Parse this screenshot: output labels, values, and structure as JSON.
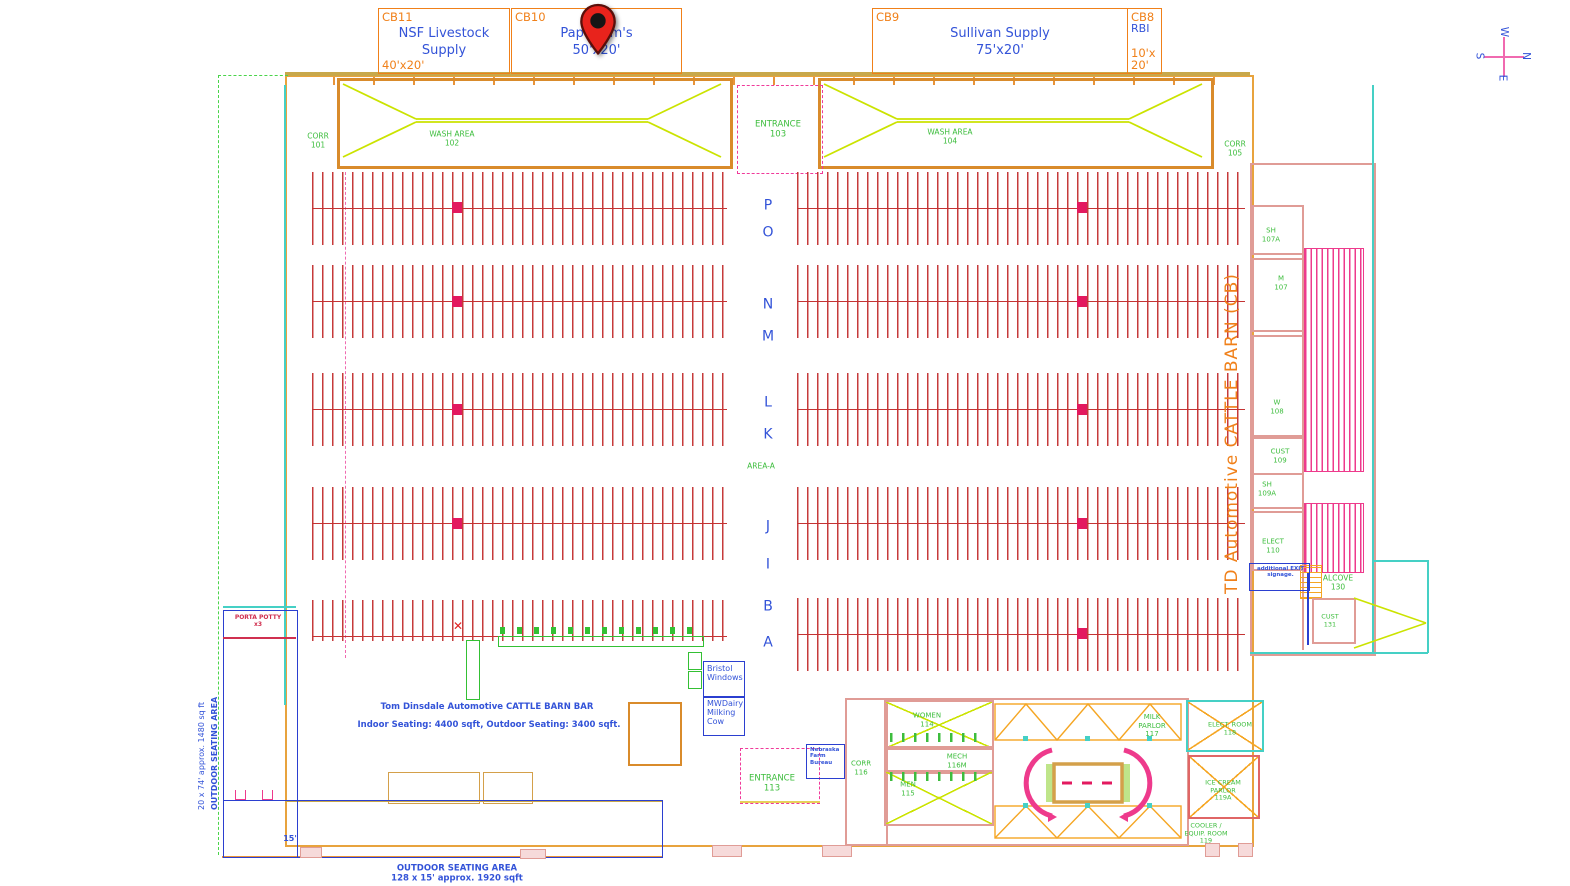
{
  "vendors": [
    {
      "id": "CB11",
      "name": "NSF Livestock\nSupply",
      "size": "40'x20'"
    },
    {
      "id": "CB10",
      "name": "Papa Tom's\n50'x20'",
      "size": ""
    },
    {
      "id": "CB9",
      "name": "Sullivan Supply\n75'x20'",
      "size": ""
    },
    {
      "id": "CB8",
      "name": "RBI",
      "size": "10'x\n20'"
    }
  ],
  "rooms": {
    "corr101": {
      "label": "CORR",
      "num": "101"
    },
    "wash102": {
      "label": "WASH AREA",
      "num": "102"
    },
    "entrance103": {
      "label": "ENTRANCE",
      "num": "103"
    },
    "wash104": {
      "label": "WASH AREA",
      "num": "104"
    },
    "corr105": {
      "label": "CORR",
      "num": "105"
    },
    "sh107a": {
      "label": "SH",
      "num": "107A"
    },
    "m107": {
      "label": "M",
      "num": "107"
    },
    "w108": {
      "label": "W",
      "num": "108"
    },
    "cust109": {
      "label": "CUST",
      "num": "109"
    },
    "sh109a": {
      "label": "SH",
      "num": "109A"
    },
    "elect110": {
      "label": "ELECT",
      "num": "110"
    },
    "alcove130": {
      "label": "ALCOVE",
      "num": "130"
    },
    "cust131": {
      "label": "CUST",
      "num": "131"
    },
    "women114": {
      "label": "WOMEN",
      "num": "114"
    },
    "mech116m": {
      "label": "MECH",
      "num": "116M"
    },
    "men115": {
      "label": "MEN",
      "num": "115"
    },
    "corr116": {
      "label": "CORR",
      "num": "116"
    },
    "milk117": {
      "label": "MILK\nPARLOR",
      "num": "117"
    },
    "elect118": {
      "label": "ELECT. ROOM",
      "num": "118"
    },
    "icecream119a": {
      "label": "ICE CREAM\nPARLOR",
      "num": "119A"
    },
    "cooler119": {
      "label": "COOLER /\nEQUIP. ROOM",
      "num": "119"
    },
    "entrance113": {
      "label": "ENTRANCE",
      "num": "113"
    }
  },
  "stalls": {
    "letters": [
      "P",
      "O",
      "N",
      "M",
      "L",
      "K",
      "J",
      "I",
      "B",
      "A"
    ],
    "area_label": "AREA-A"
  },
  "side_label": "TD Automotive CATTLE BARN (CB)",
  "bar": {
    "title": "Tom Dinsdale Automotive CATTLE BARN BAR",
    "seating": "Indoor Seating:  4400 sqft, Outdoor Seating:  3400 sqft."
  },
  "booths": {
    "bristol": "Bristol\nWindows",
    "mwdairy": "MWDairy\nMilking\nCow",
    "nfb": "Nebraska\nFarm\nBureau"
  },
  "signage": {
    "exit": "additional EXIT\nsignage.",
    "porta": "PORTA POTTY\nx3",
    "dim15": "15'"
  },
  "outdoor_left": {
    "line1": "20  x 74' approx. 1480 sq ft",
    "line2": "OUTDOOR SEATING AREA"
  },
  "outdoor_bottom": {
    "line1": "OUTDOOR SEATING AREA",
    "line2": "128 x 15' approx. 1920 sqft"
  },
  "compass": {
    "n": "N",
    "e": "E",
    "s": "S",
    "w": "W"
  },
  "colors": {
    "orange": "#f08019",
    "blue": "#3353d8",
    "green": "#3dbd3d",
    "red": "#c43333",
    "pink": "#ee3a8c",
    "yellow_green": "#cbe300",
    "cyan": "#45d0c5",
    "salmon": "#e09c96",
    "marker": "#e3195f"
  }
}
